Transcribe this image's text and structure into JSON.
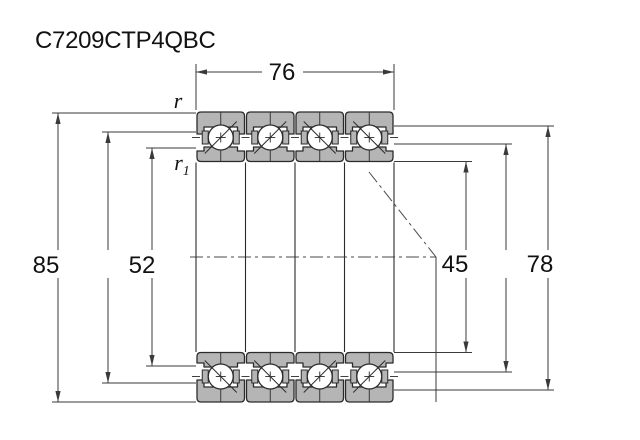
{
  "title": "C7209CTP4QBC",
  "diagram": {
    "type": "angular-contact-ball-bearing-quad-set-cross-section",
    "bearing_count": 4,
    "dimensions": {
      "overall_width": "76",
      "outer_diameter": "85",
      "inner_shoulder_diameter": "52",
      "bore_diameter": "45",
      "outer_shoulder_diameter": "78",
      "outer_chamfer_label": "r",
      "inner_chamfer_label": "r",
      "inner_chamfer_subscript": "1"
    },
    "colors": {
      "ring_fill": "#b5b5b5",
      "outline": "#2b2b2b",
      "dim_line": "#3a3a3a",
      "text": "#111111",
      "background": "#ffffff"
    }
  }
}
